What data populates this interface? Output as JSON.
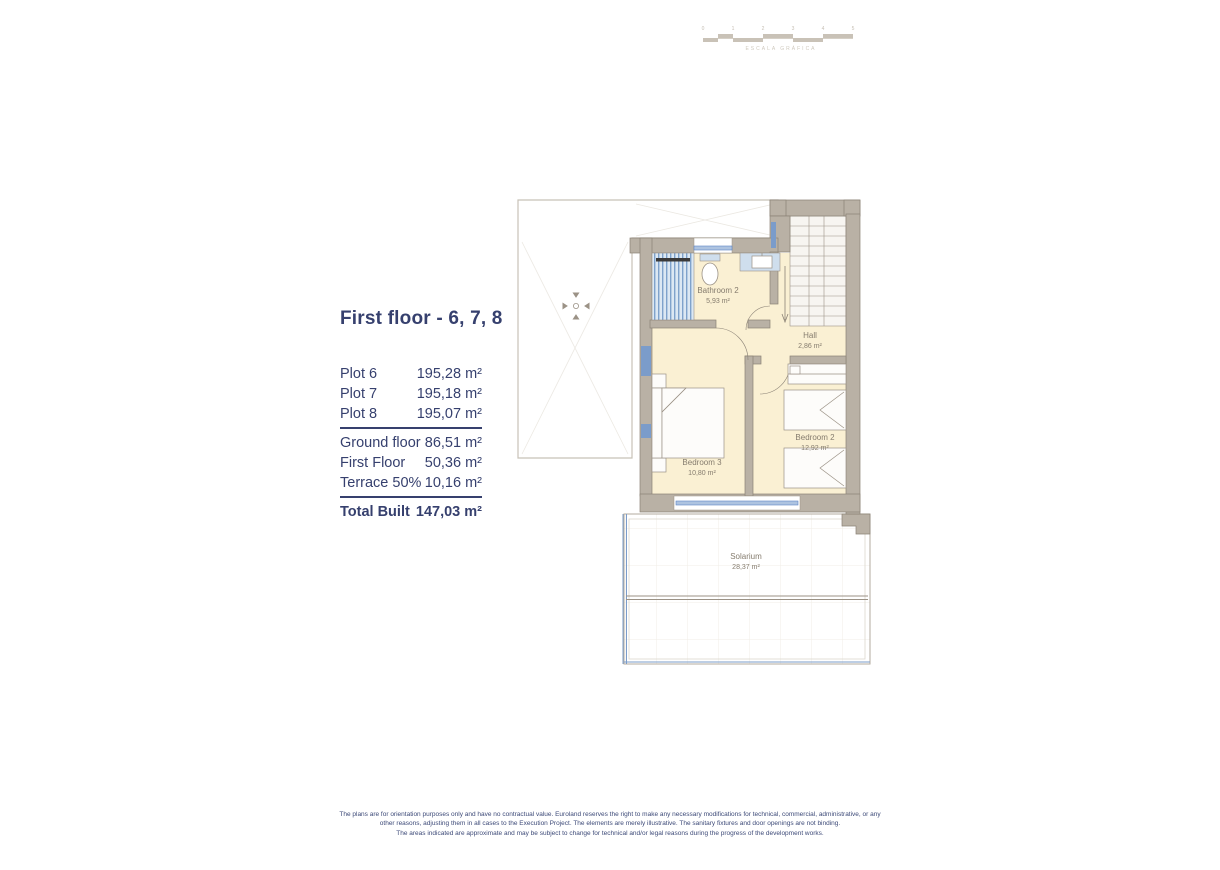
{
  "header": {
    "scale_caption": "ESCALA GRÁFICA",
    "scale_ticks": [
      "0",
      "1",
      "2",
      "3",
      "4",
      "5"
    ]
  },
  "info_panel": {
    "title": "First floor - 6, 7, 8",
    "plots": [
      {
        "label": "Plot 6",
        "value": "195,28 m²"
      },
      {
        "label": "Plot 7",
        "value": "195,18 m²"
      },
      {
        "label": "Plot 8",
        "value": "195,07 m²"
      }
    ],
    "areas": [
      {
        "label": "Ground floor",
        "value": "86,51 m²"
      },
      {
        "label": "First Floor",
        "value": "50,36 m²"
      },
      {
        "label": "Terrace 50%",
        "value": "10,16 m²"
      }
    ],
    "total": {
      "label": "Total Built",
      "value": "147,03 m²"
    }
  },
  "floor_plan": {
    "rooms": [
      {
        "name": "Bathroom 2",
        "area": "5,93 m²"
      },
      {
        "name": "Hall",
        "area": "2,86 m²"
      },
      {
        "name": "Bedroom 2",
        "area": "12,92 m²"
      },
      {
        "name": "Bedroom 3",
        "area": "10,80 m²"
      },
      {
        "name": "Solarium",
        "area": "28,37 m²"
      }
    ]
  },
  "footer": {
    "disclaimer_lines": [
      "The plans are for orientation purposes only and have no contractual value. Euroland reserves the right to make any necessary modifications for technical, commercial, administrative, or any",
      "other reasons, adjusting them in all cases to the Execution Project. The elements are merely illustrative. The sanitary fixtures and door openings are not binding.",
      "The areas indicated are approximate and may be subject to change for technical and/or legal reasons during the progress of the development works."
    ]
  },
  "colors": {
    "navy": "#36406e",
    "wall_fill": "#b9b1a5",
    "wall_stroke": "#8b8276",
    "floor_cream": "#faf0d3",
    "window_blue": "#6f93c6",
    "fixture_blue": "#cfdeed",
    "label_grey": "#857c6e"
  }
}
